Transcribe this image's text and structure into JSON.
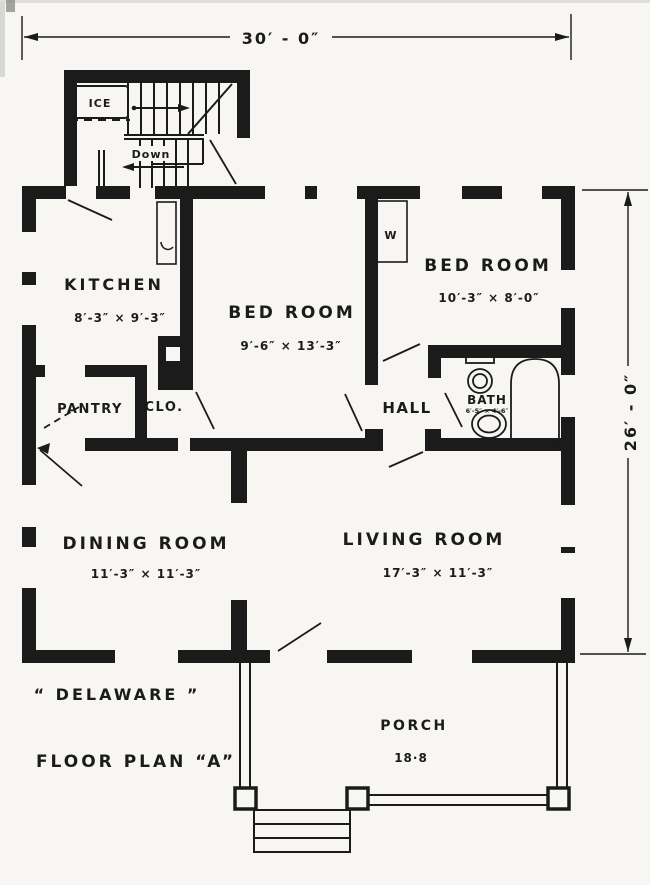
{
  "colors": {
    "ink": "#1b1b1b",
    "paper": "#f7f6f2"
  },
  "dimensions": {
    "overall_width": "30′ - 0″",
    "overall_depth": "26′ - 0″"
  },
  "rooms": {
    "kitchen": {
      "name": "KITCHEN",
      "dims": "8′-3″ × 9′-3″"
    },
    "bedroom1": {
      "name": "BED ROOM",
      "dims": "9′-6″ × 13′-3″"
    },
    "bedroom2": {
      "name": "BED ROOM",
      "dims": "10′-3″ × 8′-0″"
    },
    "pantry": {
      "name": "PANTRY"
    },
    "closet": {
      "name": "CLO."
    },
    "hall": {
      "name": "HALL"
    },
    "bath": {
      "name": "BATH",
      "dims": "6′-5″ × 4′-6″"
    },
    "dining": {
      "name": "DINING ROOM",
      "dims": "11′-3″ × 11′-3″"
    },
    "living": {
      "name": "LIVING ROOM",
      "dims": "17′-3″ × 11′-3″"
    },
    "porch": {
      "name": "PORCH",
      "dims": "18·8"
    }
  },
  "annotations": {
    "ice_box": "ICE",
    "stairs_down": "Down",
    "wardrobe": "W"
  },
  "title_block": {
    "series": "“ DELAWARE ”",
    "plan": "FLOOR PLAN “A”"
  }
}
